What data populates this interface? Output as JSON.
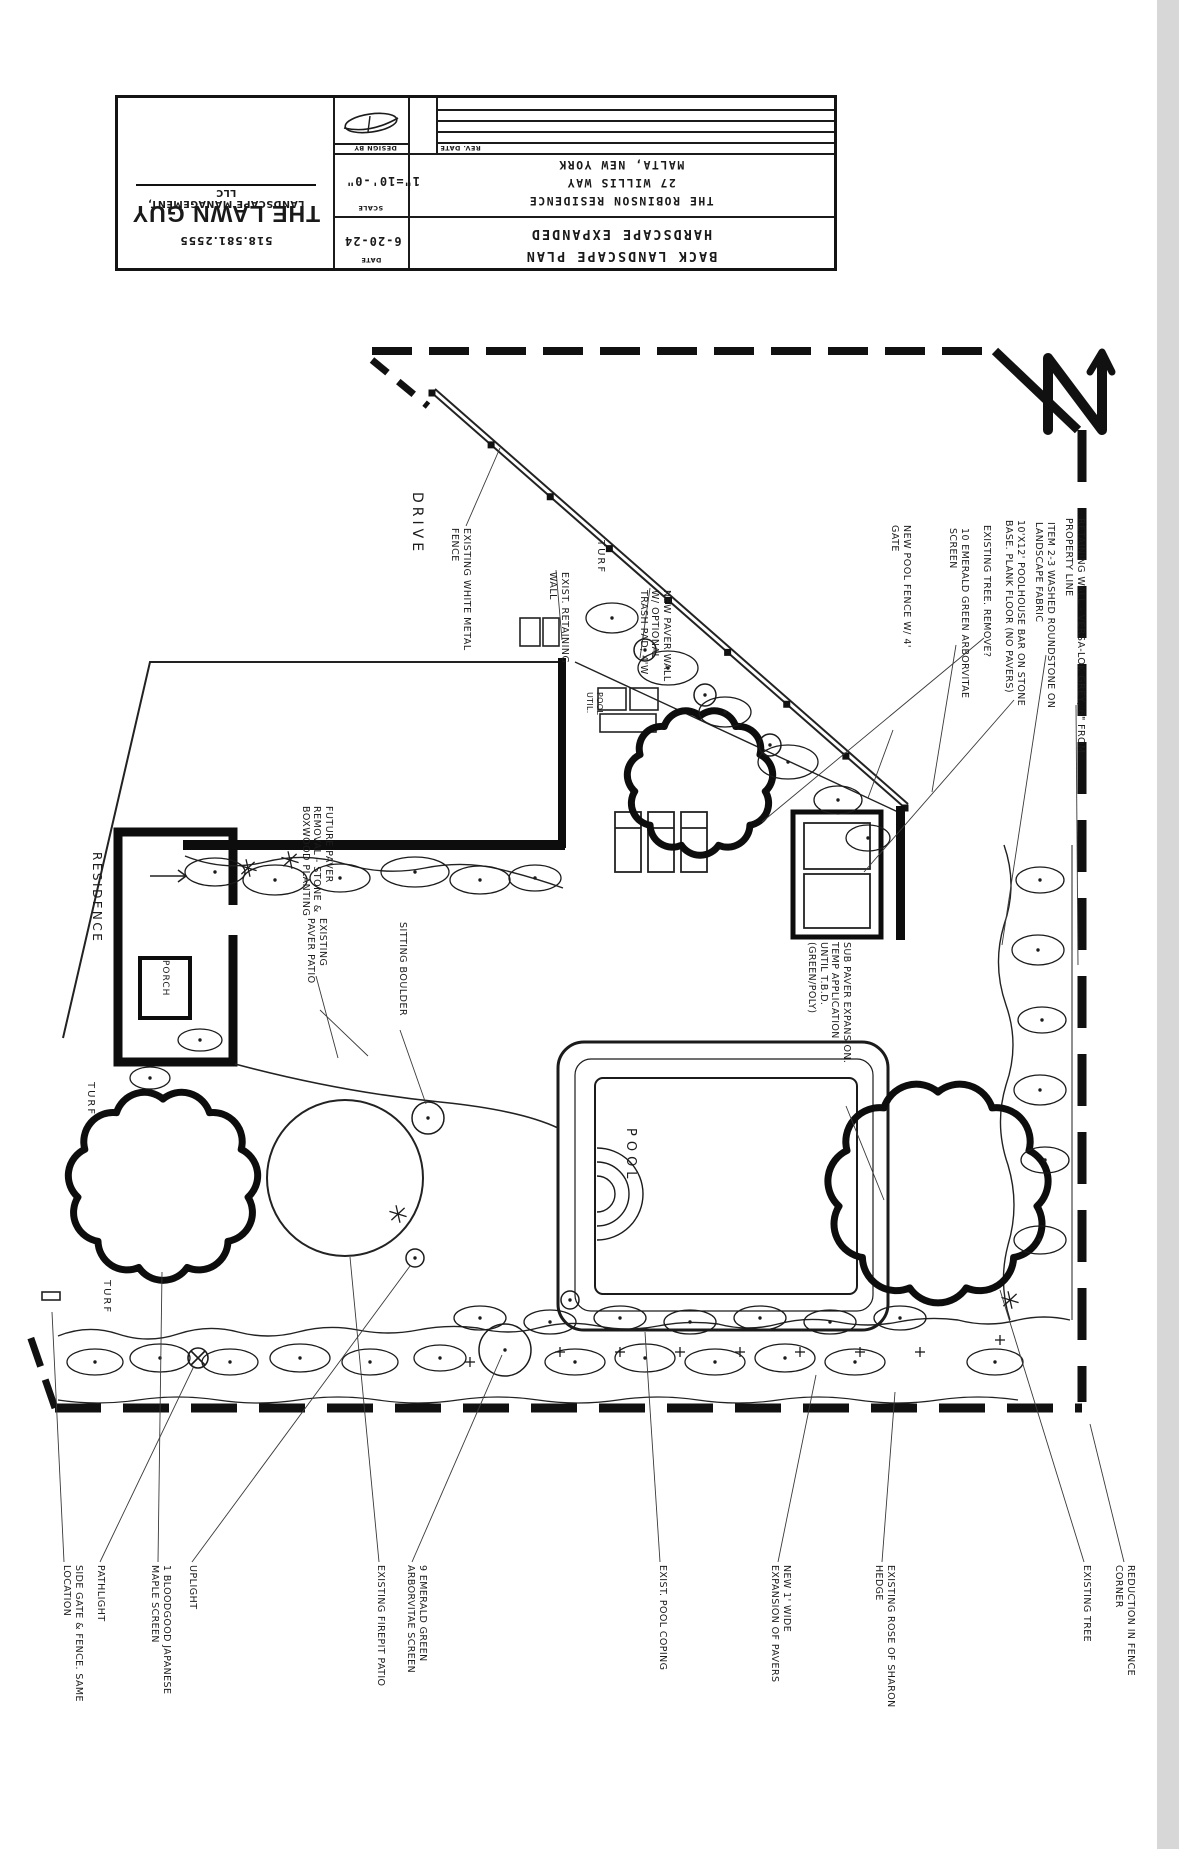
{
  "title_block": {
    "company": {
      "name": "THE LAWN GUY",
      "subtitle": "LANDSCAPE MANAGEMENT, LLC",
      "phone": "518.581.2555"
    },
    "fields": {
      "design_by_label": "DESIGN BY",
      "rev_date_label": "REV. DATE",
      "scale_label": "SCALE",
      "scale_value": "1\"=10'-0\"",
      "date_label": "DATE",
      "date_value": "6-20-24"
    },
    "project": {
      "client": "THE ROBINSON RESIDENCE",
      "address": "27 WILLIS WAY",
      "city": "MALTA, NEW YORK"
    },
    "sheet_title_line1": "BACK LANDSCAPE PLAN",
    "sheet_title_line2": "HARDSCAPE EXPANDED"
  },
  "plan": {
    "ink": "#1b1b1b",
    "labels": [
      {
        "name": "drive",
        "x": 425,
        "y": 492,
        "size": 14,
        "ls": 4,
        "text": "DRIVE"
      },
      {
        "name": "existing-white-metal-fence",
        "x": 472,
        "y": 528,
        "size": 9.5,
        "ls": 0.5,
        "text": "EXISTING WHITE METAL\nFENCE"
      },
      {
        "name": "exist-retaining-wall",
        "x": 570,
        "y": 572,
        "size": 9.5,
        "ls": 0.5,
        "text": "EXIST. RETAINING\nWALL"
      },
      {
        "name": "new-paver-wall",
        "x": 672,
        "y": 590,
        "size": 9.5,
        "ls": 0.5,
        "text": "NEW PAVER WALL\nW/ OPTIONAL\nTRASH PAD, 4'W"
      },
      {
        "name": "turf-top",
        "x": 606,
        "y": 540,
        "size": 10,
        "ls": 2,
        "text": "TURF"
      },
      {
        "name": "pool-util",
        "x": 604,
        "y": 692,
        "size": 8,
        "ls": 0.3,
        "text": "POOL\nUTIL."
      },
      {
        "name": "new-pool-fence",
        "x": 912,
        "y": 525,
        "size": 9.5,
        "ls": 0.5,
        "text": "NEW POOL FENCE W/ 4'\nGATE"
      },
      {
        "name": "ten-emerald-green",
        "x": 970,
        "y": 528,
        "size": 9.5,
        "ls": 0.4,
        "text": "10 EMERALD GREEN ARBORVITAE\nSCREEN"
      },
      {
        "name": "existing-tree-remove",
        "x": 992,
        "y": 525,
        "size": 9.5,
        "ls": 0.4,
        "text": "EXISTING TREE. REMOVE?"
      },
      {
        "name": "poolhouse-bar",
        "x": 1026,
        "y": 520,
        "size": 9.5,
        "ls": 0.4,
        "text": "10'X12' POOLHOUSE BAR ON STONE\nBASE. PLANK FLOOR (NO PAVERS)"
      },
      {
        "name": "washed-roundstone",
        "x": 1056,
        "y": 522,
        "size": 9.5,
        "ls": 0.4,
        "text": "ITEM 2-3 WASHED ROUNDSTONE ON\nLANDSCAPE FABRIC"
      },
      {
        "name": "retaining-wall-versa-lok",
        "x": 1086,
        "y": 518,
        "size": 9.5,
        "ls": 0.4,
        "text": "RETAINING WALL - VERSA-LOK GREY, 6\" FROM\nPROPERTY LINE"
      },
      {
        "name": "residence",
        "x": 104,
        "y": 852,
        "size": 12,
        "ls": 2.5,
        "text": "RESIDENCE"
      },
      {
        "name": "porch",
        "x": 170,
        "y": 960,
        "size": 9,
        "ls": 1,
        "text": "PORCH"
      },
      {
        "name": "future-paver-removal",
        "x": 334,
        "y": 806,
        "size": 9.5,
        "ls": 0.5,
        "text": "FUTURE PAVER\nREMOVAL - STONE &\nBOXWOOD PLANTING"
      },
      {
        "name": "existing-paver-patio",
        "x": 328,
        "y": 918,
        "size": 9.5,
        "ls": 0.5,
        "text": "EXISTING\nPAVER PATIO"
      },
      {
        "name": "sitting-boulder",
        "x": 408,
        "y": 922,
        "size": 9.5,
        "ls": 0.5,
        "text": "SITTING BOULDER"
      },
      {
        "name": "pool",
        "x": 638,
        "y": 1128,
        "size": 13,
        "ls": 5,
        "text": "POOL"
      },
      {
        "name": "sub-paver-expansion",
        "x": 852,
        "y": 942,
        "size": 9.5,
        "ls": 0.4,
        "text": "SUB PAVER EXPANSION.\nTEMP APPLICATION\nUNTIL T.B.D.\n(GREEN/POLY)"
      },
      {
        "name": "turf-mid",
        "x": 96,
        "y": 1082,
        "size": 10,
        "ls": 2,
        "text": "TURF"
      },
      {
        "name": "turf-bottom",
        "x": 112,
        "y": 1280,
        "size": 10,
        "ls": 2,
        "text": "TURF"
      },
      {
        "name": "side-gate-fence",
        "x": 84,
        "y": 1565,
        "size": 9.5,
        "ls": 0.4,
        "text": "SIDE GATE & FENCE. SAME\nLOCATION"
      },
      {
        "name": "pathlight",
        "x": 106,
        "y": 1565,
        "size": 9.5,
        "ls": 0.5,
        "text": "PATHLIGHT"
      },
      {
        "name": "bloodgood-japanese-maple",
        "x": 172,
        "y": 1565,
        "size": 9.5,
        "ls": 0.4,
        "text": "1 BLOODGOOD JAPANESE\nMAPLE SCREEN"
      },
      {
        "name": "uplight",
        "x": 198,
        "y": 1565,
        "size": 9.5,
        "ls": 0.5,
        "text": "UPLIGHT"
      },
      {
        "name": "existing-firepit-patio",
        "x": 386,
        "y": 1565,
        "size": 9.5,
        "ls": 0.4,
        "text": "EXISTING FIREPIT PATIO"
      },
      {
        "name": "nine-emerald-green",
        "x": 428,
        "y": 1565,
        "size": 9.5,
        "ls": 0.4,
        "text": "9 EMERALD GREEN\nARBORVITAE SCREEN"
      },
      {
        "name": "exist-pool-coping",
        "x": 668,
        "y": 1565,
        "size": 9.5,
        "ls": 0.4,
        "text": "EXIST. POOL COPING"
      },
      {
        "name": "new-expansion-pavers",
        "x": 792,
        "y": 1565,
        "size": 9.5,
        "ls": 0.4,
        "text": "NEW 1' WIDE\nEXPANSION OF PAVERS"
      },
      {
        "name": "existing-rose-of-sharon",
        "x": 896,
        "y": 1565,
        "size": 9.5,
        "ls": 0.4,
        "text": "EXISTING ROSE OF SHARON\nHEDGE"
      },
      {
        "name": "existing-tree",
        "x": 1092,
        "y": 1565,
        "size": 9.5,
        "ls": 0.4,
        "text": "EXISTING TREE"
      },
      {
        "name": "reduction-fence-corner",
        "x": 1136,
        "y": 1565,
        "size": 9.5,
        "ls": 0.4,
        "text": "REDUCTION IN FENCE\nCORNER"
      }
    ],
    "trees": [
      {
        "cx": 700,
        "cy": 782,
        "r": 66
      },
      {
        "cx": 163,
        "cy": 1185,
        "r": 86
      },
      {
        "cx": 938,
        "cy": 1192,
        "r": 100
      }
    ],
    "fence": {
      "x1": 432,
      "y1": 393,
      "x2": 905,
      "y2": 808,
      "posts": 9
    },
    "shrubs": [
      [
        612,
        618,
        26,
        15
      ],
      [
        668,
        668,
        30,
        17
      ],
      [
        725,
        712,
        26,
        15
      ],
      [
        788,
        762,
        30,
        17
      ],
      [
        838,
        800,
        24,
        14
      ],
      [
        868,
        838,
        22,
        13
      ],
      [
        215,
        872,
        30,
        14
      ],
      [
        275,
        880,
        32,
        15
      ],
      [
        340,
        878,
        30,
        14
      ],
      [
        415,
        872,
        34,
        15
      ],
      [
        480,
        880,
        30,
        14
      ],
      [
        535,
        878,
        26,
        13
      ],
      [
        200,
        1040,
        22,
        11
      ],
      [
        150,
        1078,
        20,
        11
      ],
      [
        1040,
        880,
        24,
        13
      ],
      [
        1038,
        950,
        26,
        15
      ],
      [
        1042,
        1020,
        24,
        13
      ],
      [
        1040,
        1090,
        26,
        15
      ],
      [
        1045,
        1160,
        24,
        13
      ],
      [
        1040,
        1240,
        26,
        14
      ],
      [
        95,
        1362,
        28,
        13
      ],
      [
        160,
        1358,
        30,
        14
      ],
      [
        230,
        1362,
        28,
        13
      ],
      [
        300,
        1358,
        30,
        14
      ],
      [
        370,
        1362,
        28,
        13
      ],
      [
        440,
        1358,
        26,
        13
      ],
      [
        575,
        1362,
        30,
        13
      ],
      [
        645,
        1358,
        30,
        14
      ],
      [
        715,
        1362,
        30,
        13
      ],
      [
        785,
        1358,
        30,
        14
      ],
      [
        855,
        1362,
        30,
        13
      ],
      [
        995,
        1362,
        28,
        13
      ],
      [
        480,
        1318,
        26,
        12
      ],
      [
        550,
        1322,
        26,
        12
      ],
      [
        620,
        1318,
        26,
        12
      ],
      [
        690,
        1322,
        26,
        12
      ],
      [
        760,
        1318,
        26,
        12
      ],
      [
        830,
        1322,
        26,
        12
      ],
      [
        900,
        1318,
        26,
        12
      ]
    ],
    "circles": [
      [
        645,
        650,
        11
      ],
      [
        705,
        695,
        11
      ],
      [
        770,
        745,
        11
      ],
      [
        428,
        1118,
        16
      ],
      [
        415,
        1258,
        9
      ],
      [
        505,
        1350,
        26
      ],
      [
        570,
        1300,
        9
      ]
    ],
    "stars": [
      [
        290,
        860
      ],
      [
        248,
        868
      ],
      [
        398,
        1214
      ],
      [
        1010,
        1300
      ]
    ],
    "plus_marks": [
      [
        560,
        1352
      ],
      [
        620,
        1352
      ],
      [
        680,
        1352
      ],
      [
        740,
        1352
      ],
      [
        800,
        1352
      ],
      [
        860,
        1352
      ],
      [
        920,
        1352
      ],
      [
        470,
        1362
      ],
      [
        1000,
        1340
      ]
    ],
    "leaders": [
      [
        466,
        526,
        500,
        448
      ],
      [
        556,
        570,
        562,
        640
      ],
      [
        650,
        588,
        640,
        658
      ],
      [
        893,
        730,
        868,
        798
      ],
      [
        956,
        645,
        932,
        792
      ],
      [
        984,
        638,
        762,
        822
      ],
      [
        1014,
        700,
        864,
        872
      ],
      [
        1046,
        655,
        1002,
        945
      ],
      [
        1076,
        705,
        1078,
        965
      ],
      [
        316,
        976,
        338,
        1058
      ],
      [
        320,
        1010,
        368,
        1056
      ],
      [
        400,
        1030,
        426,
        1104
      ],
      [
        846,
        1106,
        884,
        1200
      ],
      [
        64,
        1562,
        52,
        1312
      ],
      [
        100,
        1562,
        194,
        1366
      ],
      [
        158,
        1562,
        162,
        1272
      ],
      [
        192,
        1562,
        410,
        1266
      ],
      [
        379,
        1562,
        350,
        1257
      ],
      [
        412,
        1562,
        502,
        1355
      ],
      [
        660,
        1562,
        645,
        1332
      ],
      [
        778,
        1562,
        816,
        1375
      ],
      [
        882,
        1562,
        895,
        1392
      ],
      [
        1084,
        1562,
        1000,
        1290
      ],
      [
        1124,
        1562,
        1090,
        1424
      ]
    ]
  }
}
